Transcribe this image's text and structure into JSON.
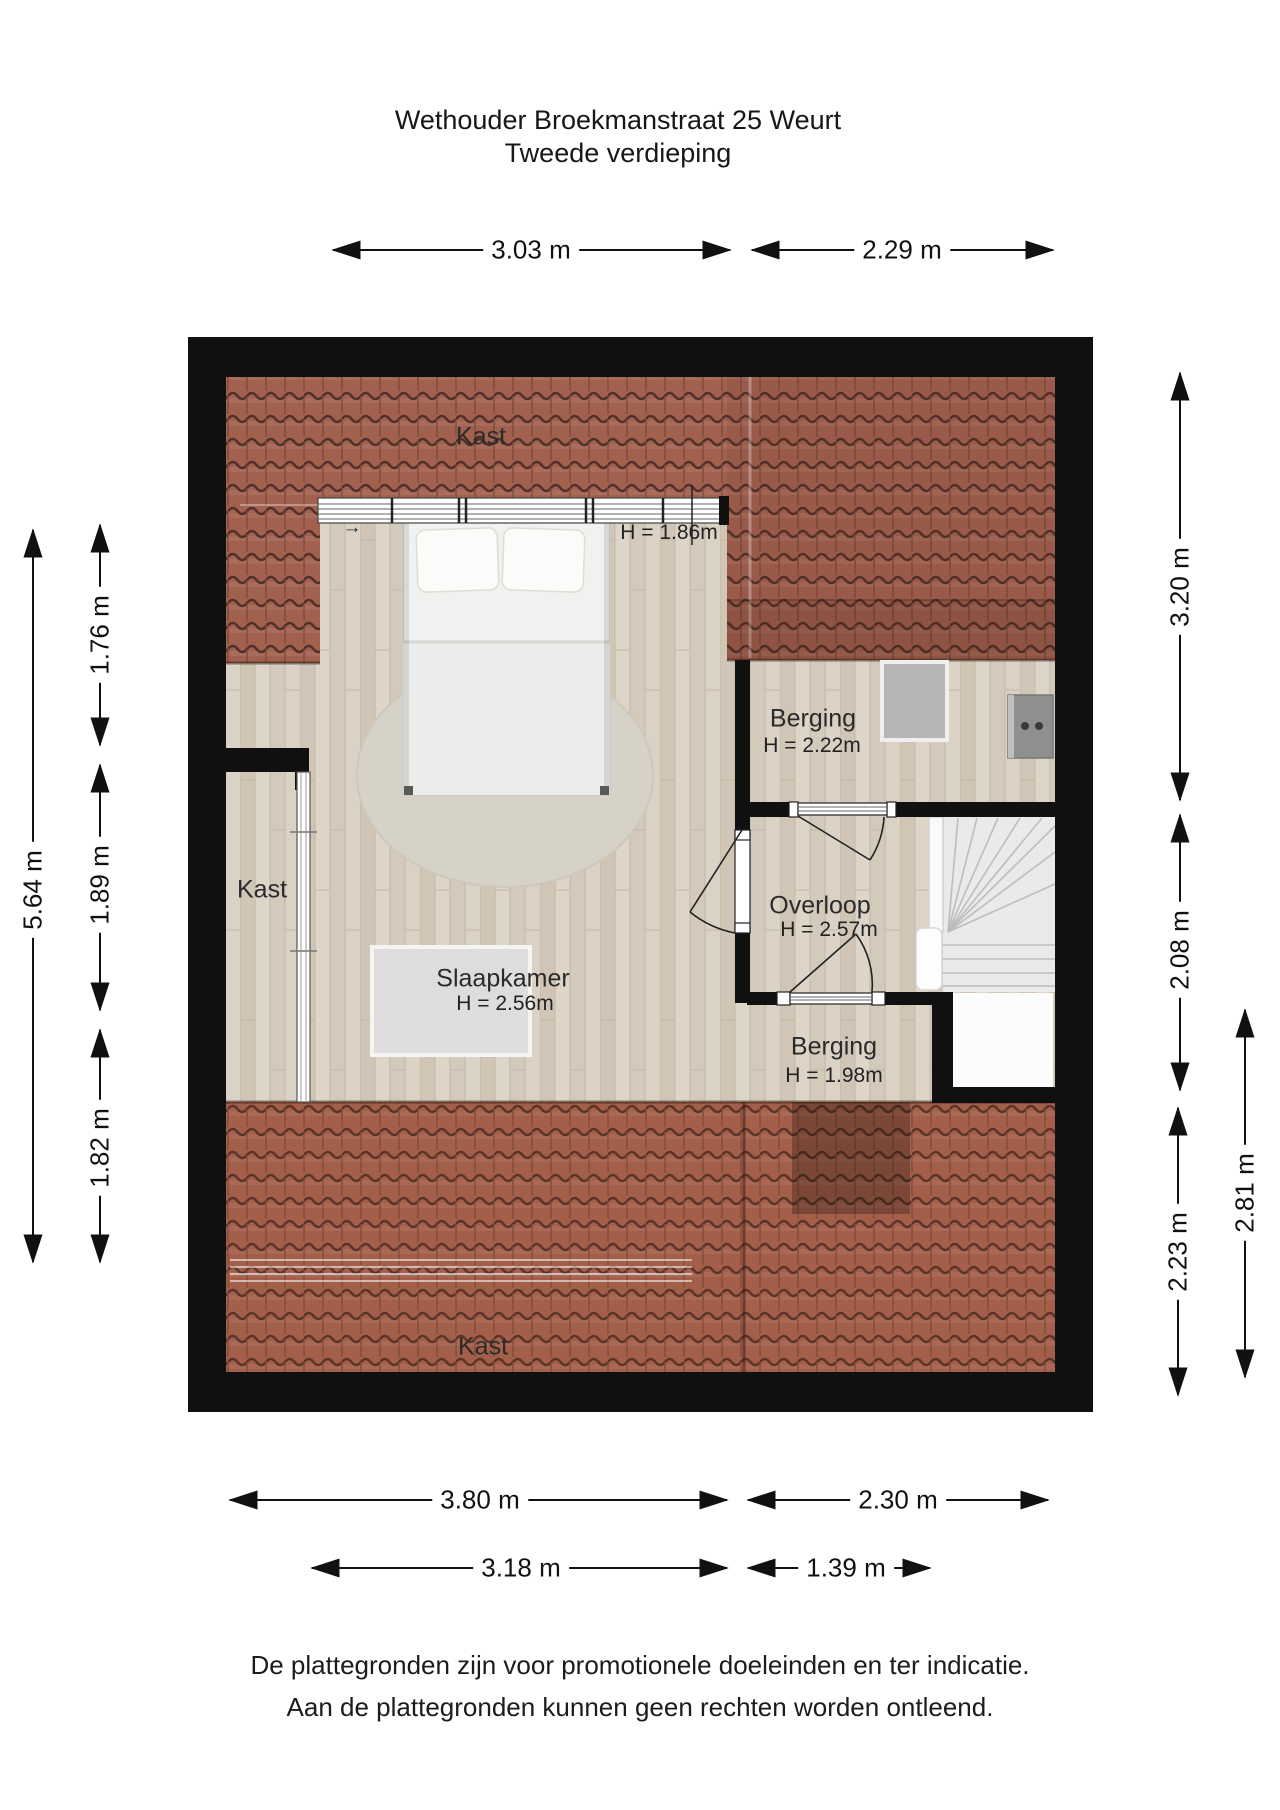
{
  "title": {
    "line1": "Wethouder Broekmanstraat 25 Weurt",
    "line2": "Tweede verdieping"
  },
  "rooms": {
    "kast_top": {
      "label": "Kast"
    },
    "kast_left": {
      "label": "Kast"
    },
    "kast_bottom": {
      "label": "Kast"
    },
    "slaapkamer": {
      "label": "Slaapkamer",
      "height": "H = 2.56m"
    },
    "berging_top": {
      "label": "Berging",
      "height": "H = 2.22m"
    },
    "overloop": {
      "label": "Overloop",
      "height": "H = 2.57m"
    },
    "berging_bottom": {
      "label": "Berging",
      "height": "H = 1.98m"
    },
    "dormer_window": {
      "height": "H = 1.86m"
    }
  },
  "dimensions": {
    "top": {
      "d1": "3.03 m",
      "d2": "2.29 m"
    },
    "bottom": {
      "d1": "3.80 m",
      "d2": "2.30 m",
      "d3": "3.18 m",
      "d4": "1.39 m"
    },
    "left": {
      "overall": "5.64 m",
      "upper": "1.76 m",
      "middle": "1.89 m",
      "lower": "1.82 m"
    },
    "right": {
      "upper": "3.20 m",
      "middle": "2.08 m",
      "lower": "2.23 m",
      "outer": "2.81 m"
    }
  },
  "disclaimer": {
    "line1": "De plattegronden zijn voor promotionele doeleinden en ter indicatie.",
    "line2": "Aan de plattegronden kunnen geen rechten worden ontleend."
  },
  "icons": {
    "slide_direction": "→"
  },
  "colors": {
    "wall": "#101010",
    "roof_tile": "#a2604e",
    "roof_tile_line": "#503029",
    "wood_floor": "#d8cfc2",
    "rug": "#d6d2c7",
    "stairs": "#eaeaea",
    "panel_gray": "#b5b5b5",
    "unit_gray": "#8f8f8f"
  }
}
